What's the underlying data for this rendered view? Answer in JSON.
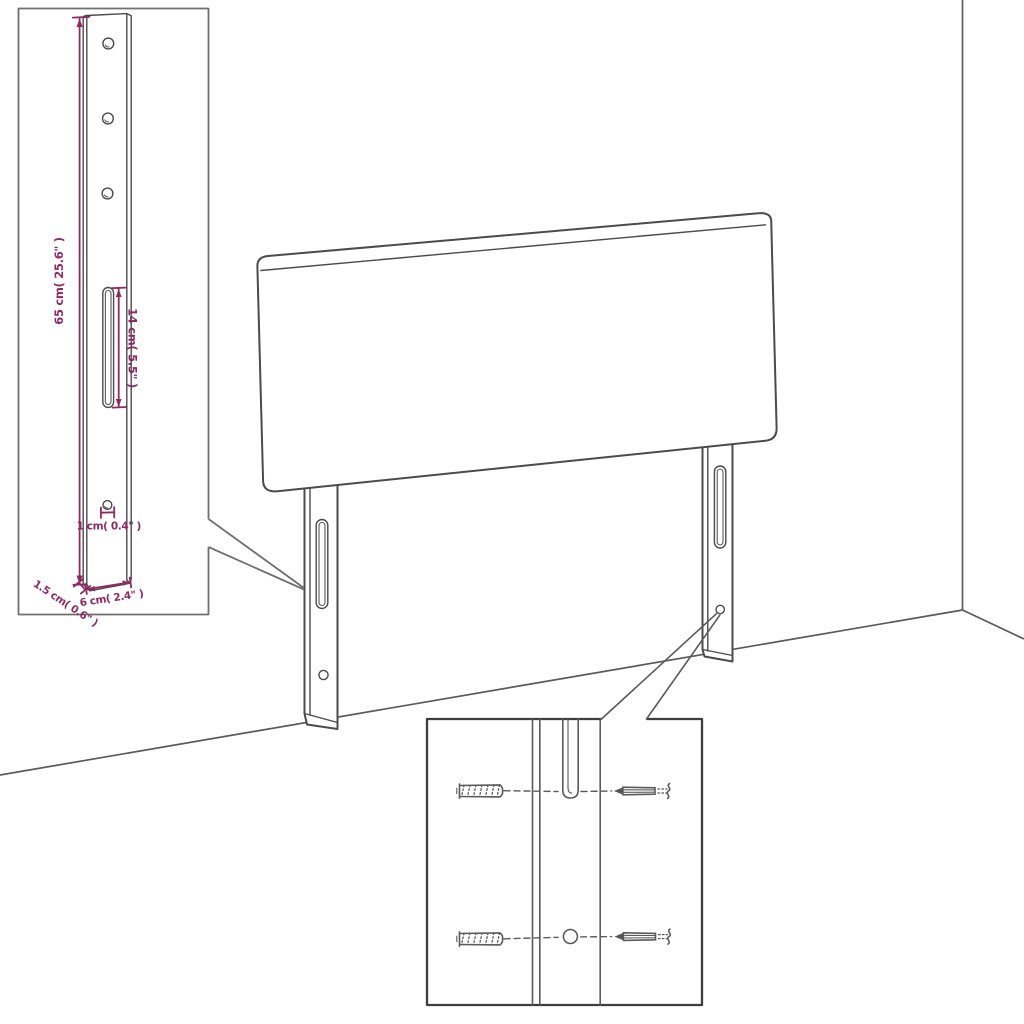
{
  "diagram": {
    "title": "Headboard with adjustable legs - product dimension diagram",
    "colors": {
      "accent": "#8d2a64",
      "drawing_line": "#4b4b4b",
      "detail_inset_border": "#6f6f6f",
      "hardware_inset_border": "#3e3e3e",
      "background": "#ffffff"
    },
    "dimensions": {
      "leg_height": {
        "label": "65 cm( 25.6\" )"
      },
      "slot_length": {
        "label": "14 cm( 5.5\" )"
      },
      "hole_diameter": {
        "label": "1 cm( 0.4\" )"
      },
      "leg_thickness": {
        "label": "1.5 cm( 0.6\" )"
      },
      "leg_width": {
        "label": "6 cm( 2.4\" )"
      }
    }
  }
}
